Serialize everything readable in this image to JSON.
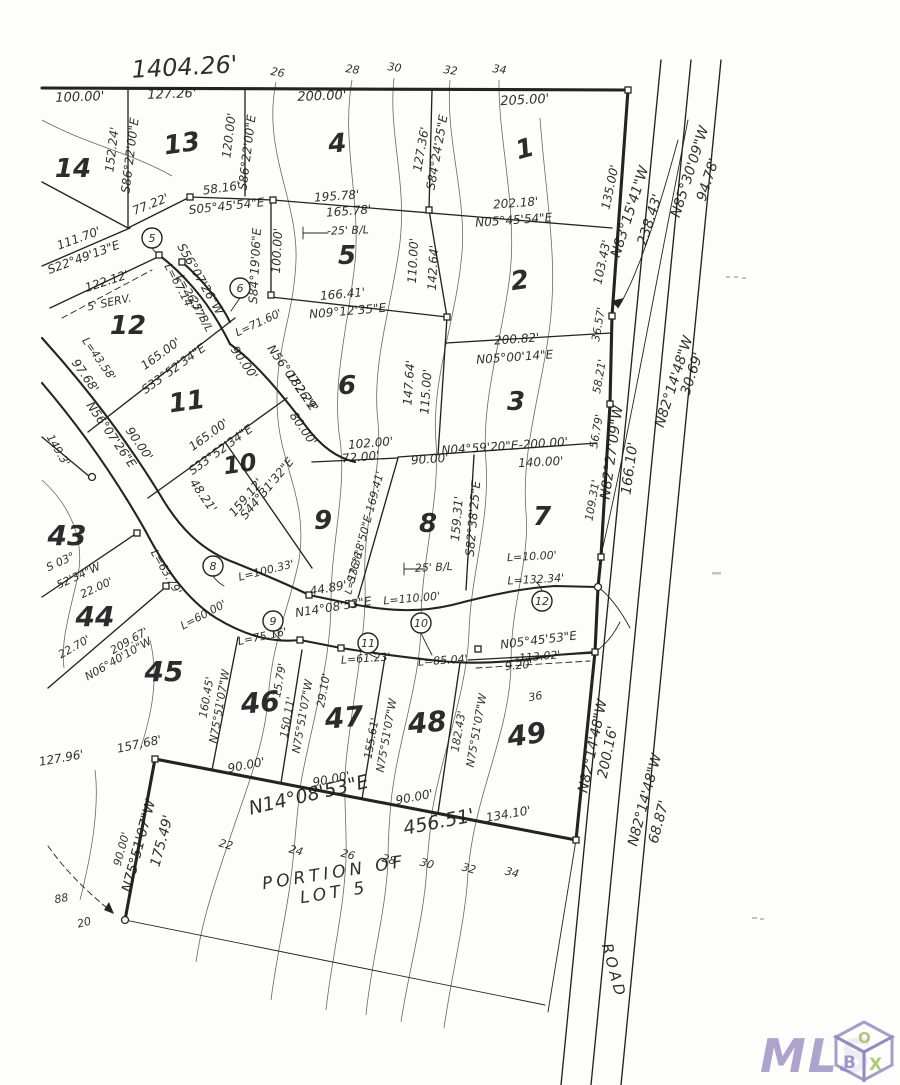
{
  "title_dimension": "1404.26'",
  "portion_note": {
    "line1": "PORTION OF",
    "line2": "LOT 5"
  },
  "road": {
    "name": "ROAD"
  },
  "logo": {
    "mls": "MLS",
    "cube_letters": [
      "B",
      "O",
      "X"
    ],
    "purple": "#9187bd",
    "green": "#9fc15e"
  },
  "lots": [
    {
      "n": "14",
      "x": 73,
      "y": 177,
      "r": 0,
      "s": 26
    },
    {
      "n": "13",
      "x": 183,
      "y": 152,
      "r": -8,
      "s": 26
    },
    {
      "n": "4",
      "x": 338,
      "y": 152,
      "r": -5,
      "s": 26
    },
    {
      "n": "1",
      "x": 527,
      "y": 157,
      "r": -15,
      "s": 26
    },
    {
      "n": "5",
      "x": 347,
      "y": 264,
      "r": 0,
      "s": 26
    },
    {
      "n": "2",
      "x": 521,
      "y": 289,
      "r": -8,
      "s": 26
    },
    {
      "n": "12",
      "x": 128,
      "y": 334,
      "r": 0,
      "s": 26
    },
    {
      "n": "6",
      "x": 347,
      "y": 394,
      "r": 0,
      "s": 26
    },
    {
      "n": "3",
      "x": 516,
      "y": 410,
      "r": 0,
      "s": 26
    },
    {
      "n": "11",
      "x": 188,
      "y": 410,
      "r": -8,
      "s": 26
    },
    {
      "n": "10",
      "x": 241,
      "y": 472,
      "r": -8,
      "s": 24
    },
    {
      "n": "9",
      "x": 323,
      "y": 529,
      "r": 0,
      "s": 26
    },
    {
      "n": "8",
      "x": 428,
      "y": 532,
      "r": 0,
      "s": 26
    },
    {
      "n": "7",
      "x": 542,
      "y": 525,
      "r": 0,
      "s": 26
    },
    {
      "n": "43",
      "x": 67,
      "y": 545,
      "r": 0,
      "s": 28
    },
    {
      "n": "44",
      "x": 95,
      "y": 626,
      "r": 0,
      "s": 28
    },
    {
      "n": "45",
      "x": 164,
      "y": 681,
      "r": 0,
      "s": 28
    },
    {
      "n": "46",
      "x": 261,
      "y": 712,
      "r": -5,
      "s": 28
    },
    {
      "n": "47",
      "x": 345,
      "y": 727,
      "r": -5,
      "s": 28
    },
    {
      "n": "48",
      "x": 428,
      "y": 732,
      "r": -5,
      "s": 28
    },
    {
      "n": "49",
      "x": 528,
      "y": 744,
      "r": -8,
      "s": 28
    }
  ],
  "curve_points": [
    {
      "n": "5",
      "x": 152,
      "y": 238
    },
    {
      "n": "6",
      "x": 240,
      "y": 288
    },
    {
      "n": "8",
      "x": 213,
      "y": 566
    },
    {
      "n": "9",
      "x": 273,
      "y": 621
    },
    {
      "n": "10",
      "x": 421,
      "y": 623
    },
    {
      "n": "11",
      "x": 368,
      "y": 643
    },
    {
      "n": "12",
      "x": 542,
      "y": 601
    }
  ],
  "labels": [
    {
      "t": "1404.26'",
      "x": 185,
      "y": 75,
      "r": -3,
      "s": 24
    },
    {
      "t": "100.00'",
      "x": 80,
      "y": 101,
      "r": -2,
      "s": 13
    },
    {
      "t": "127.26'",
      "x": 172,
      "y": 98,
      "r": -2,
      "s": 13
    },
    {
      "t": "200.00'",
      "x": 322,
      "y": 100,
      "r": -2,
      "s": 13
    },
    {
      "t": "205.00'",
      "x": 525,
      "y": 104,
      "r": -3,
      "s": 13
    },
    {
      "t": "26",
      "x": 277,
      "y": 76,
      "r": 10,
      "s": 11
    },
    {
      "t": "28",
      "x": 352,
      "y": 73,
      "r": 8,
      "s": 11
    },
    {
      "t": "30",
      "x": 394,
      "y": 71,
      "r": 8,
      "s": 11
    },
    {
      "t": "32",
      "x": 450,
      "y": 74,
      "r": 8,
      "s": 11
    },
    {
      "t": "34",
      "x": 499,
      "y": 73,
      "r": 8,
      "s": 11
    },
    {
      "t": "152.24'",
      "x": 116,
      "y": 150,
      "r": -83,
      "s": 12
    },
    {
      "t": "S86°22'00\"E",
      "x": 134,
      "y": 156,
      "r": -83,
      "s": 12
    },
    {
      "t": "120.00'",
      "x": 233,
      "y": 136,
      "r": -83,
      "s": 12
    },
    {
      "t": "S86°22'00\"E",
      "x": 251,
      "y": 153,
      "r": -83,
      "s": 12
    },
    {
      "t": "127.36'",
      "x": 425,
      "y": 150,
      "r": -80,
      "s": 12
    },
    {
      "t": "S84°24'25\"E",
      "x": 441,
      "y": 153,
      "r": -80,
      "s": 12
    },
    {
      "t": "135.00'",
      "x": 614,
      "y": 188,
      "r": -78,
      "s": 12
    },
    {
      "t": "N83°15'41\"W",
      "x": 634,
      "y": 213,
      "r": -72,
      "s": 14
    },
    {
      "t": "238.43'",
      "x": 654,
      "y": 221,
      "r": -72,
      "s": 14
    },
    {
      "t": "N85°30'09\"W",
      "x": 694,
      "y": 173,
      "r": -72,
      "s": 14
    },
    {
      "t": "94.78'",
      "x": 712,
      "y": 181,
      "r": -72,
      "s": 14
    },
    {
      "t": "58.16'",
      "x": 222,
      "y": 192,
      "r": -8,
      "s": 12
    },
    {
      "t": "77.22'",
      "x": 152,
      "y": 208,
      "r": -22,
      "s": 12
    },
    {
      "t": "S05°45'54\"E",
      "x": 227,
      "y": 210,
      "r": -6,
      "s": 12
    },
    {
      "t": "195.78'",
      "x": 337,
      "y": 200,
      "r": -4,
      "s": 12
    },
    {
      "t": "165.78'",
      "x": 349,
      "y": 215,
      "r": -4,
      "s": 12
    },
    {
      "t": "-25' B/L",
      "x": 348,
      "y": 234,
      "r": -2,
      "s": 11
    },
    {
      "t": "100.00'",
      "x": 281,
      "y": 251,
      "r": -87,
      "s": 12
    },
    {
      "t": "S84°19'06\"E",
      "x": 259,
      "y": 266,
      "r": -87,
      "s": 12
    },
    {
      "t": "111.70'",
      "x": 80,
      "y": 242,
      "r": -20,
      "s": 12
    },
    {
      "t": "S22°49'13\"E",
      "x": 85,
      "y": 261,
      "r": -20,
      "s": 12
    },
    {
      "t": "S56°07'26\"W",
      "x": 197,
      "y": 281,
      "r": 60,
      "s": 12
    },
    {
      "t": "L=67.14'",
      "x": 176,
      "y": 288,
      "r": 62,
      "s": 11
    },
    {
      "t": "L=26.77'",
      "x": 188,
      "y": 299,
      "r": 62,
      "s": 11
    },
    {
      "t": "25' B/L",
      "x": 198,
      "y": 316,
      "r": 62,
      "s": 11
    },
    {
      "t": "122.12'",
      "x": 108,
      "y": 285,
      "r": -18,
      "s": 12
    },
    {
      "t": "5' SERV.",
      "x": 110,
      "y": 306,
      "r": -12,
      "s": 11
    },
    {
      "t": "L=71.60'",
      "x": 260,
      "y": 326,
      "r": -25,
      "s": 11
    },
    {
      "t": "166.41'",
      "x": 343,
      "y": 298,
      "r": -5,
      "s": 12
    },
    {
      "t": "N09°12'35\"E",
      "x": 348,
      "y": 315,
      "r": -5,
      "s": 12
    },
    {
      "t": "110.00'",
      "x": 417,
      "y": 261,
      "r": -87,
      "s": 12
    },
    {
      "t": "142.64'",
      "x": 437,
      "y": 268,
      "r": -87,
      "s": 12
    },
    {
      "t": "202.18'",
      "x": 516,
      "y": 207,
      "r": -4,
      "s": 12
    },
    {
      "t": "N05°45'54\"E",
      "x": 514,
      "y": 224,
      "r": -4,
      "s": 12
    },
    {
      "t": "103.43'",
      "x": 606,
      "y": 263,
      "r": -78,
      "s": 12
    },
    {
      "t": "36.57'",
      "x": 602,
      "y": 325,
      "r": -80,
      "s": 11
    },
    {
      "t": "58.21'",
      "x": 603,
      "y": 377,
      "r": -80,
      "s": 11
    },
    {
      "t": "56.79'",
      "x": 600,
      "y": 432,
      "r": -80,
      "s": 11
    },
    {
      "t": "109.31'",
      "x": 596,
      "y": 501,
      "r": -80,
      "s": 11
    },
    {
      "t": "N82°27'09\"W",
      "x": 616,
      "y": 453,
      "r": -82,
      "s": 14
    },
    {
      "t": "166.10'",
      "x": 634,
      "y": 469,
      "r": -82,
      "s": 14
    },
    {
      "t": "N82°14'48\"W",
      "x": 678,
      "y": 383,
      "r": -72,
      "s": 14
    },
    {
      "t": "30.69'",
      "x": 696,
      "y": 375,
      "r": -72,
      "s": 14
    },
    {
      "t": "200.82'",
      "x": 517,
      "y": 343,
      "r": -4,
      "s": 12
    },
    {
      "t": "N05°00'14\"E",
      "x": 515,
      "y": 361,
      "r": -4,
      "s": 12
    },
    {
      "t": "147.64'",
      "x": 413,
      "y": 383,
      "r": -86,
      "s": 12
    },
    {
      "t": "115.00'",
      "x": 430,
      "y": 392,
      "r": -86,
      "s": 12
    },
    {
      "t": "N56°07'26\"E",
      "x": 289,
      "y": 380,
      "r": 55,
      "s": 12
    },
    {
      "t": "182.29'",
      "x": 299,
      "y": 394,
      "r": 55,
      "s": 12
    },
    {
      "t": "80.00'",
      "x": 300,
      "y": 431,
      "r": 55,
      "s": 12
    },
    {
      "t": "90.00'",
      "x": 241,
      "y": 365,
      "r": 55,
      "s": 12
    },
    {
      "t": "L=43.58'",
      "x": 96,
      "y": 361,
      "r": 55,
      "s": 11
    },
    {
      "t": "97.68'",
      "x": 82,
      "y": 378,
      "r": 55,
      "s": 12
    },
    {
      "t": "N56°07'26\"E",
      "x": 108,
      "y": 437,
      "r": 55,
      "s": 12
    },
    {
      "t": "90.00'",
      "x": 136,
      "y": 446,
      "r": 55,
      "s": 12
    },
    {
      "t": "165.00'",
      "x": 163,
      "y": 357,
      "r": -36,
      "s": 12
    },
    {
      "t": "S33°52'34\"E",
      "x": 176,
      "y": 372,
      "r": -36,
      "s": 12
    },
    {
      "t": "165.00'",
      "x": 211,
      "y": 438,
      "r": -36,
      "s": 12
    },
    {
      "t": "S33°52'34\"E",
      "x": 223,
      "y": 453,
      "r": -36,
      "s": 12
    },
    {
      "t": "48.21'",
      "x": 200,
      "y": 498,
      "r": 55,
      "s": 12
    },
    {
      "t": "L=63.79'",
      "x": 163,
      "y": 574,
      "r": 60,
      "s": 11
    },
    {
      "t": "159.12'",
      "x": 249,
      "y": 500,
      "r": -50,
      "s": 12
    },
    {
      "t": "S44°31'32\"E",
      "x": 270,
      "y": 491,
      "r": -50,
      "s": 12
    },
    {
      "t": "102.00'",
      "x": 371,
      "y": 447,
      "r": -5,
      "s": 12
    },
    {
      "t": "72.00'",
      "x": 361,
      "y": 461,
      "r": -5,
      "s": 12
    },
    {
      "t": "90.00'",
      "x": 430,
      "y": 463,
      "r": -4,
      "s": 12
    },
    {
      "t": "140.00'",
      "x": 541,
      "y": 466,
      "r": -3,
      "s": 12
    },
    {
      "t": "N04°59'20\"E-200.00'",
      "x": 505,
      "y": 450,
      "r": -4,
      "s": 12
    },
    {
      "t": "159.31'",
      "x": 461,
      "y": 519,
      "r": -85,
      "s": 12
    },
    {
      "t": "S82°38'25\"E",
      "x": 477,
      "y": 519,
      "r": -85,
      "s": 12
    },
    {
      "t": "S76°18'50\"E-169.41'",
      "x": 369,
      "y": 528,
      "r": -75,
      "s": 11
    },
    {
      "t": "L=13.36'",
      "x": 357,
      "y": 573,
      "r": -75,
      "s": 10
    },
    {
      "t": "-25' B/L",
      "x": 432,
      "y": 571,
      "r": -3,
      "s": 11
    },
    {
      "t": "L=10.00'",
      "x": 532,
      "y": 560,
      "r": -3,
      "s": 11
    },
    {
      "t": "L=132.34'",
      "x": 536,
      "y": 583,
      "r": -3,
      "s": 11
    },
    {
      "t": "L=110.00'",
      "x": 412,
      "y": 602,
      "r": -5,
      "s": 11
    },
    {
      "t": "L=100.33'",
      "x": 267,
      "y": 574,
      "r": -14,
      "s": 11
    },
    {
      "t": "44.89'",
      "x": 329,
      "y": 592,
      "r": -10,
      "s": 12
    },
    {
      "t": "N14°08'53\"E",
      "x": 334,
      "y": 611,
      "r": -9,
      "s": 12
    },
    {
      "t": "L=60.00'",
      "x": 205,
      "y": 618,
      "r": -28,
      "s": 11
    },
    {
      "t": "L=75.16'",
      "x": 263,
      "y": 640,
      "r": -12,
      "s": 11
    },
    {
      "t": "L=61.23'",
      "x": 366,
      "y": 662,
      "r": -4,
      "s": 11
    },
    {
      "t": "L=85.04'",
      "x": 443,
      "y": 664,
      "r": -4,
      "s": 11
    },
    {
      "t": "N05°45'53\"E",
      "x": 539,
      "y": 644,
      "r": -7,
      "s": 12
    },
    {
      "t": "-113.02'-",
      "x": 540,
      "y": 660,
      "r": -5,
      "s": 11
    },
    {
      "t": "9.20'",
      "x": 519,
      "y": 669,
      "r": -5,
      "s": 11
    },
    {
      "t": "S 03°",
      "x": 62,
      "y": 565,
      "r": -25,
      "s": 11
    },
    {
      "t": "52'34\"W",
      "x": 80,
      "y": 579,
      "r": -25,
      "s": 11
    },
    {
      "t": "22.00'",
      "x": 98,
      "y": 591,
      "r": -25,
      "s": 11
    },
    {
      "t": "149.3'",
      "x": 55,
      "y": 452,
      "r": 60,
      "s": 11
    },
    {
      "t": "22.70'",
      "x": 76,
      "y": 650,
      "r": -30,
      "s": 11
    },
    {
      "t": "209.67'",
      "x": 131,
      "y": 644,
      "r": -30,
      "s": 11
    },
    {
      "t": "N06°40'10\"W",
      "x": 120,
      "y": 662,
      "r": -30,
      "s": 11
    },
    {
      "t": "157.68'",
      "x": 140,
      "y": 748,
      "r": -12,
      "s": 12
    },
    {
      "t": "127.96'",
      "x": 62,
      "y": 762,
      "r": -10,
      "s": 12
    },
    {
      "t": "160.45'",
      "x": 210,
      "y": 698,
      "r": -80,
      "s": 11
    },
    {
      "t": "N75°51'07\"W",
      "x": 223,
      "y": 707,
      "r": -80,
      "s": 11
    },
    {
      "t": "15.79'",
      "x": 283,
      "y": 681,
      "r": -80,
      "s": 11
    },
    {
      "t": "150.11'",
      "x": 291,
      "y": 718,
      "r": -80,
      "s": 11
    },
    {
      "t": "N75°51'07\"W",
      "x": 306,
      "y": 717,
      "r": -80,
      "s": 11
    },
    {
      "t": "29.10'",
      "x": 327,
      "y": 691,
      "r": -80,
      "s": 11
    },
    {
      "t": "155.61'",
      "x": 375,
      "y": 739,
      "r": -80,
      "s": 11
    },
    {
      "t": "N75°51'07\"W",
      "x": 390,
      "y": 736,
      "r": -80,
      "s": 11
    },
    {
      "t": "182.43'",
      "x": 462,
      "y": 732,
      "r": -80,
      "s": 11
    },
    {
      "t": "N75°51'07\"W",
      "x": 480,
      "y": 731,
      "r": -80,
      "s": 11
    },
    {
      "t": "N75°51'07\"W",
      "x": 143,
      "y": 847,
      "r": -75,
      "s": 14
    },
    {
      "t": "175.49'",
      "x": 166,
      "y": 842,
      "r": -75,
      "s": 14
    },
    {
      "t": "90.00'",
      "x": 125,
      "y": 850,
      "r": -75,
      "s": 11
    },
    {
      "t": "90.00'",
      "x": 247,
      "y": 769,
      "r": -11,
      "s": 12
    },
    {
      "t": "90.00'",
      "x": 332,
      "y": 783,
      "r": -11,
      "s": 12
    },
    {
      "t": "90.00'",
      "x": 415,
      "y": 801,
      "r": -11,
      "s": 12
    },
    {
      "t": "N14°08'53\"E",
      "x": 310,
      "y": 801,
      "r": -13,
      "s": 19
    },
    {
      "t": "456.51'",
      "x": 440,
      "y": 828,
      "r": -11,
      "s": 19
    },
    {
      "t": "134.10'",
      "x": 509,
      "y": 818,
      "r": -10,
      "s": 12
    },
    {
      "t": "N82°14'48\"W",
      "x": 597,
      "y": 747,
      "r": -78,
      "s": 14
    },
    {
      "t": "200.16'",
      "x": 612,
      "y": 753,
      "r": -78,
      "s": 14
    },
    {
      "t": "N82°14'48\"W",
      "x": 649,
      "y": 801,
      "r": -75,
      "s": 14
    },
    {
      "t": "68.87'",
      "x": 663,
      "y": 823,
      "r": -75,
      "s": 14
    },
    {
      "t": "ROAD",
      "x": 609,
      "y": 972,
      "r": 75,
      "s": 15,
      "ls": 3
    },
    {
      "t": "22",
      "x": 225,
      "y": 848,
      "r": 15,
      "s": 11
    },
    {
      "t": "24",
      "x": 295,
      "y": 854,
      "r": 15,
      "s": 11
    },
    {
      "t": "26",
      "x": 347,
      "y": 858,
      "r": 15,
      "s": 11
    },
    {
      "t": "28",
      "x": 388,
      "y": 863,
      "r": 15,
      "s": 11
    },
    {
      "t": "30",
      "x": 426,
      "y": 867,
      "r": 15,
      "s": 11
    },
    {
      "t": "32",
      "x": 468,
      "y": 872,
      "r": 15,
      "s": 11
    },
    {
      "t": "34",
      "x": 511,
      "y": 876,
      "r": 15,
      "s": 11
    },
    {
      "t": "36",
      "x": 536,
      "y": 700,
      "r": -10,
      "s": 11
    },
    {
      "t": "88",
      "x": 62,
      "y": 902,
      "r": -10,
      "s": 11
    },
    {
      "t": "20",
      "x": 85,
      "y": 926,
      "r": -15,
      "s": 11
    },
    {
      "t": "PORTION OF",
      "x": 335,
      "y": 878,
      "r": -9,
      "s": 17,
      "ls": 4
    },
    {
      "t": "LOT 5",
      "x": 335,
      "y": 898,
      "r": -9,
      "s": 17,
      "ls": 4
    }
  ]
}
